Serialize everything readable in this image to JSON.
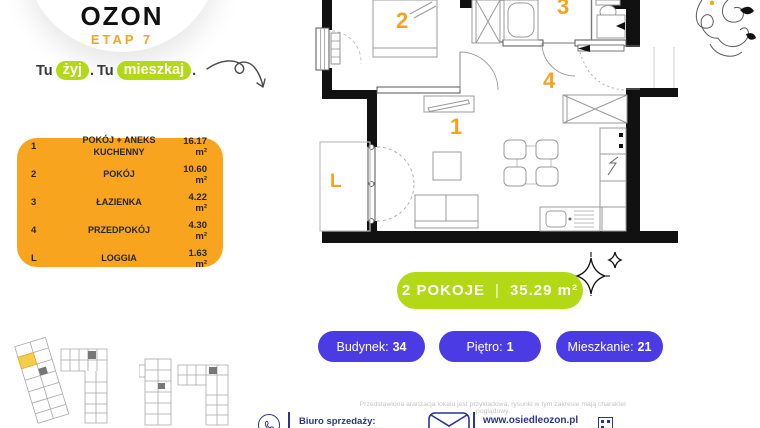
{
  "brand": {
    "logo": "OZON",
    "etap": "ETAP 7"
  },
  "tagline": {
    "word1": "Tu",
    "pill1": "żyj",
    "dot1": ".",
    "word2": "Tu",
    "pill2": "mieszkaj",
    "dot2": "."
  },
  "legend": {
    "rows": [
      {
        "no": "1",
        "name": "POKÓJ + ANEKS KUCHENNY",
        "area": "16.17 m²"
      },
      {
        "no": "2",
        "name": "POKÓJ",
        "area": "10.60 m²"
      },
      {
        "no": "3",
        "name": "ŁAZIENKA",
        "area": "4.22 m²"
      },
      {
        "no": "4",
        "name": "PRZEDPOKÓJ",
        "area": "4.30 m²"
      },
      {
        "no": "L",
        "name": "LOGGIA",
        "area": "1.63 m²"
      }
    ]
  },
  "plan": {
    "labels": {
      "room1": "1",
      "room2": "2",
      "room3": "3",
      "room4": "4",
      "loggia": "L"
    }
  },
  "summary": {
    "rooms": "2 POKOJE",
    "separator": "|",
    "area": "35.29 m²"
  },
  "badges": [
    {
      "label": "Budynek:",
      "value": "34"
    },
    {
      "label": "Piętro:",
      "value": "1"
    },
    {
      "label": "Mieszkanie:",
      "value": "21"
    }
  ],
  "footer": {
    "disclaimer": "Przedstawiona aranżacja lokalu jest przykładowa, rysunki w tym zakresie mają charakter poglądowy.",
    "office_label": "Biuro sprzedaży:",
    "website": "www.osiedleozon.pl"
  },
  "colors": {
    "orange": "#F8A41F",
    "lime": "#B2D816",
    "purple": "#4B3BE4",
    "navy": "#2B3490",
    "plan_label_orange": "#F6A21E",
    "highlight_yellow": "#F2CE4A"
  }
}
